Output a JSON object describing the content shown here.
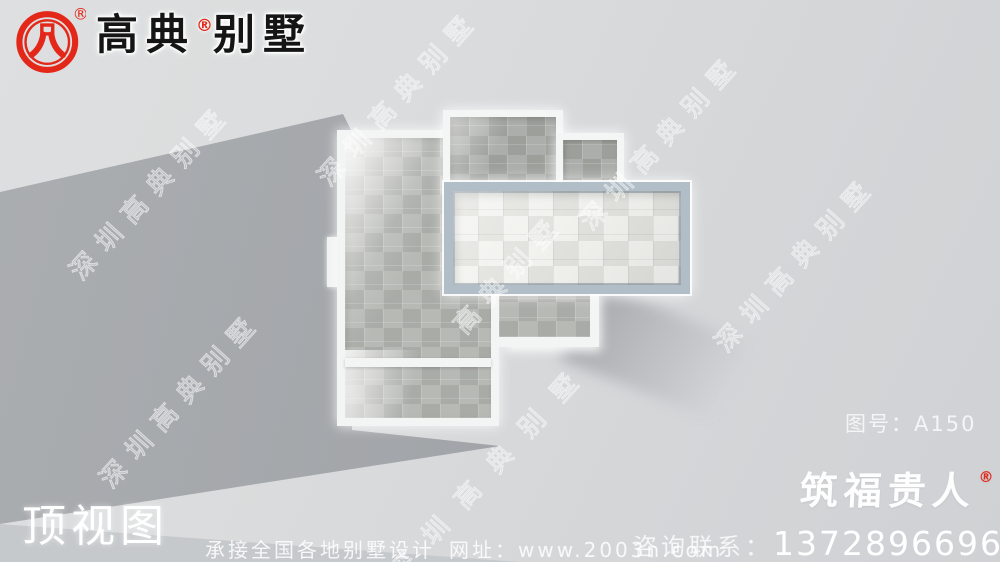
{
  "brand": {
    "name_prefix": "高典",
    "registered_mark": "®",
    "name_suffix": "别墅",
    "logo_icon": "gaodian-arch-emblem",
    "logo_registered_mark": "®"
  },
  "view_label": "顶视图",
  "drawing_number": {
    "text": "图号：A150"
  },
  "watermark": {
    "text": "深圳高典别墅",
    "short_text": "高典别墅"
  },
  "secondary_brand": {
    "name": "筑福贵人",
    "registered_mark": "®"
  },
  "footer": {
    "service_text": "承接全国各地别墅设计",
    "website_label": "网址：",
    "website_url": "www.2003n.com",
    "contact_label": "咨询联系：",
    "phone_number": "13728966966"
  },
  "colors": {
    "accent_red": "#e32819",
    "roof_wall_white": "#f3f4f4",
    "terrace_parapet_blue_gray": "#b1bec7",
    "roof_tile_gray": "#afb1ad",
    "roof_tile_dark": "#a3a5a1",
    "roof_tile_light": "#e7e7e2",
    "ground_shadow": "#a1a4a8",
    "background_gray": "#d7d9da"
  }
}
